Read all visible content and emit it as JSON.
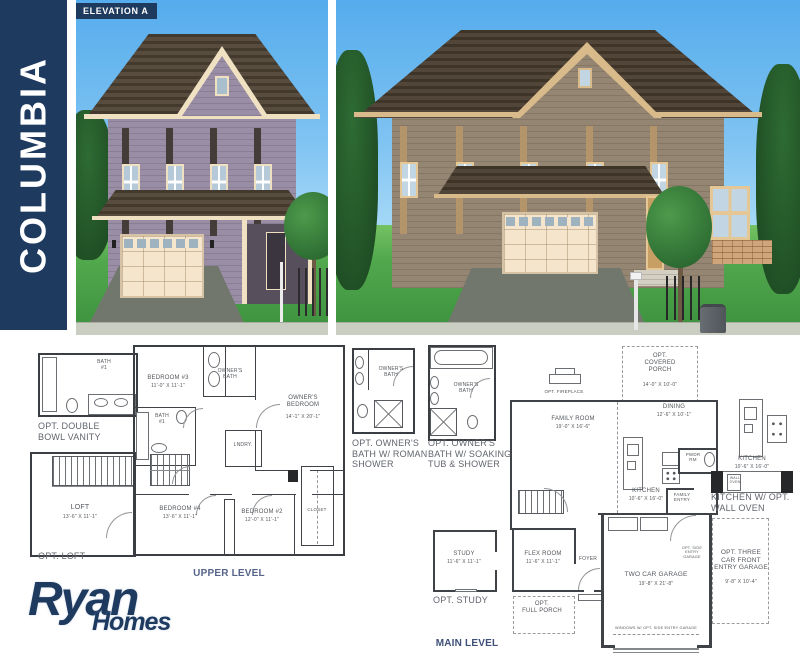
{
  "sidebar": {
    "title": "COLUMBIA"
  },
  "elevation_badge": "ELEVATION A",
  "logo": {
    "primary": "Ryan",
    "secondary": "Homes"
  },
  "colors": {
    "navy": "#1e3a5f",
    "sky": "#7fc3f2",
    "grass": "#4ea04a",
    "roof_brown": "#4e4233",
    "siding_elevation_a": "#958aa0",
    "siding_elevation_b": "#8e8071",
    "trim_cream": "#efe0c2",
    "trim_tan": "#d9ba8a",
    "plan_line": "#3f4246",
    "caption_gray": "#61666d",
    "level_blue": "#46547a"
  },
  "plan_labels": {
    "upper_options": [
      {
        "n": "label-bath1-vanity",
        "t": "BATH\n#1",
        "x": 104,
        "y": 360,
        "fs": 5
      },
      {
        "n": "caption-opt-double-bowl-vanity",
        "t": "OPT. DOUBLE\nBOWL VANITY",
        "x": 38,
        "y": 421,
        "fs": 9,
        "c": "#61666d",
        "a": "l"
      },
      {
        "n": "label-loft",
        "t": "LOFT",
        "x": 80,
        "y": 504,
        "fs": 7
      },
      {
        "n": "label-loft-dims",
        "t": "13'-6\" X 11'-1\"",
        "x": 80,
        "y": 515,
        "fs": 5
      },
      {
        "n": "caption-opt-loft",
        "t": "OPT. LOFT",
        "x": 38,
        "y": 551,
        "fs": 9,
        "c": "#61666d",
        "a": "l"
      }
    ],
    "upper_level": [
      {
        "n": "label-bedroom-3",
        "t": "BEDROOM #3",
        "x": 168,
        "y": 375,
        "fs": 6
      },
      {
        "n": "label-bedroom-3-dims",
        "t": "11'-0\" X 11'-1\"",
        "x": 168,
        "y": 384,
        "fs": 5
      },
      {
        "n": "label-owners-bath",
        "t": "OWNER'S\nBATH",
        "x": 230,
        "y": 369,
        "fs": 5
      },
      {
        "n": "label-owners-bedroom",
        "t": "OWNER'S\nBEDROOM",
        "x": 303,
        "y": 395,
        "fs": 6
      },
      {
        "n": "label-owners-bedroom-dims",
        "t": "14'-1\" X 20'-1\"",
        "x": 303,
        "y": 415,
        "fs": 5
      },
      {
        "n": "label-bath-1",
        "t": "BATH\n#1",
        "x": 162,
        "y": 414,
        "fs": 5
      },
      {
        "n": "label-laundry",
        "t": "LNDRY.",
        "x": 243,
        "y": 443,
        "fs": 5
      },
      {
        "n": "label-bedroom-4",
        "t": "BEDROOM #4",
        "x": 180,
        "y": 506,
        "fs": 6
      },
      {
        "n": "label-bedroom-4-dims",
        "t": "13'-6\" X 11'-1\"",
        "x": 180,
        "y": 515,
        "fs": 5
      },
      {
        "n": "label-bedroom-2",
        "t": "BEDROOM #2",
        "x": 262,
        "y": 509,
        "fs": 6
      },
      {
        "n": "label-bedroom-2-dims",
        "t": "12'-0\" X 11'-1\"",
        "x": 262,
        "y": 518,
        "fs": 5
      },
      {
        "n": "label-closet",
        "t": "CLOSET",
        "x": 317,
        "y": 507,
        "fs": 4.5
      },
      {
        "n": "caption-upper-level",
        "t": "UPPER LEVEL",
        "x": 229,
        "y": 568,
        "fs": 10,
        "c": "#56648a",
        "b": 1
      }
    ],
    "bath_options": [
      {
        "n": "label-opt-bath-roman",
        "t": "OWNER'S\nBATH",
        "x": 391,
        "y": 367,
        "fs": 5
      },
      {
        "n": "caption-opt-roman-shower",
        "t": "OPT. OWNER'S\nBATH W/ ROMAN\nSHOWER",
        "x": 352,
        "y": 438,
        "fs": 9,
        "c": "#61666d",
        "a": "l"
      },
      {
        "n": "label-opt-bath-soaking",
        "t": "OWNER'S\nBATH",
        "x": 466,
        "y": 383,
        "fs": 5
      },
      {
        "n": "caption-opt-soaking-tub",
        "t": "OPT. OWNER'S\nBATH W/ SOAKING\nTUB & SHOWER",
        "x": 428,
        "y": 438,
        "fs": 9,
        "c": "#61666d",
        "a": "l"
      }
    ],
    "main_level": [
      {
        "n": "label-opt-covered-porch",
        "t": "OPT.\nCOVERED\nPORCH",
        "x": 660,
        "y": 353,
        "fs": 6
      },
      {
        "n": "label-opt-covered-porch-dims",
        "t": "14'-0\" X 10'-0\"",
        "x": 660,
        "y": 383,
        "fs": 5
      },
      {
        "n": "caption-opt-fireplace",
        "t": "OPT. FIREPLACE",
        "x": 564,
        "y": 389,
        "fs": 4.5
      },
      {
        "n": "label-family-room",
        "t": "FAMILY ROOM",
        "x": 573,
        "y": 416,
        "fs": 6
      },
      {
        "n": "label-family-room-dims",
        "t": "19'-0\" X 16'-6\"",
        "x": 573,
        "y": 425,
        "fs": 5
      },
      {
        "n": "label-dining",
        "t": "DINING",
        "x": 674,
        "y": 404,
        "fs": 6
      },
      {
        "n": "label-dining-dims",
        "t": "12'-6\" X 10'-1\"",
        "x": 674,
        "y": 413,
        "fs": 5
      },
      {
        "n": "label-kitchen",
        "t": "KITCHEN",
        "x": 646,
        "y": 488,
        "fs": 6
      },
      {
        "n": "label-kitchen-dims",
        "t": "10'-6\" X 16'-0\"",
        "x": 646,
        "y": 497,
        "fs": 5
      },
      {
        "n": "label-powder-room",
        "t": "PWDR\nRM",
        "x": 693,
        "y": 452,
        "fs": 4.5
      },
      {
        "n": "label-family-entry",
        "t": "FAMILY\nENTRY",
        "x": 682,
        "y": 492,
        "fs": 4.5
      },
      {
        "n": "label-foyer",
        "t": "FOYER",
        "x": 588,
        "y": 557,
        "fs": 5
      },
      {
        "n": "label-flex-room",
        "t": "FLEX ROOM",
        "x": 543,
        "y": 551,
        "fs": 6
      },
      {
        "n": "label-flex-room-dims",
        "t": "11'-6\" X 11'-1\"",
        "x": 543,
        "y": 560,
        "fs": 5
      },
      {
        "n": "label-opt-full-porch",
        "t": "OPT.\nFULL PORCH",
        "x": 542,
        "y": 601,
        "fs": 6
      },
      {
        "n": "label-study",
        "t": "STUDY",
        "x": 464,
        "y": 551,
        "fs": 6
      },
      {
        "n": "label-study-dims",
        "t": "11'-6\" X 11'-1\"",
        "x": 464,
        "y": 560,
        "fs": 5
      },
      {
        "n": "caption-opt-study",
        "t": "OPT. STUDY",
        "x": 433,
        "y": 595,
        "fs": 9,
        "c": "#61666d",
        "a": "l"
      },
      {
        "n": "label-two-car-garage",
        "t": "TWO CAR GARAGE",
        "x": 656,
        "y": 571,
        "fs": 6.5
      },
      {
        "n": "label-two-car-garage-dims",
        "t": "19'-8\" X 21'-8\"",
        "x": 656,
        "y": 582,
        "fs": 5
      },
      {
        "n": "label-opt-side-entry",
        "t": "OPT. SIDE\nENTRY\nGARAGE",
        "x": 692,
        "y": 546,
        "fs": 3.8
      },
      {
        "n": "label-windows-note",
        "t": "WINDOWS W/ OPT. SIDE ENTRY GARAGE",
        "x": 656,
        "y": 626,
        "fs": 3.8
      },
      {
        "n": "label-opt-three-car",
        "t": "OPT. THREE\nCAR FRONT\nENTRY GARAGE",
        "x": 741,
        "y": 549,
        "fs": 6.5
      },
      {
        "n": "label-opt-three-car-dims",
        "t": "9'-8\" X 10'-4\"",
        "x": 741,
        "y": 580,
        "fs": 5
      },
      {
        "n": "label-opt-kitchen",
        "t": "KITCHEN",
        "x": 752,
        "y": 456,
        "fs": 6
      },
      {
        "n": "label-opt-kitchen-dims",
        "t": "10'-6\" X 16'-0\"",
        "x": 752,
        "y": 465,
        "fs": 5
      },
      {
        "n": "label-wall-oven",
        "t": "WALL\nOVEN",
        "x": 735,
        "y": 476,
        "fs": 3.5
      },
      {
        "n": "caption-kitchen-wall-oven",
        "t": "KITCHEN W/ OPT.\nWALL OVEN",
        "x": 711,
        "y": 492,
        "fs": 9,
        "c": "#61666d",
        "a": "l"
      },
      {
        "n": "caption-main-level",
        "t": "MAIN LEVEL",
        "x": 467,
        "y": 638,
        "fs": 10,
        "c": "#3e5078",
        "b": 1
      }
    ]
  }
}
